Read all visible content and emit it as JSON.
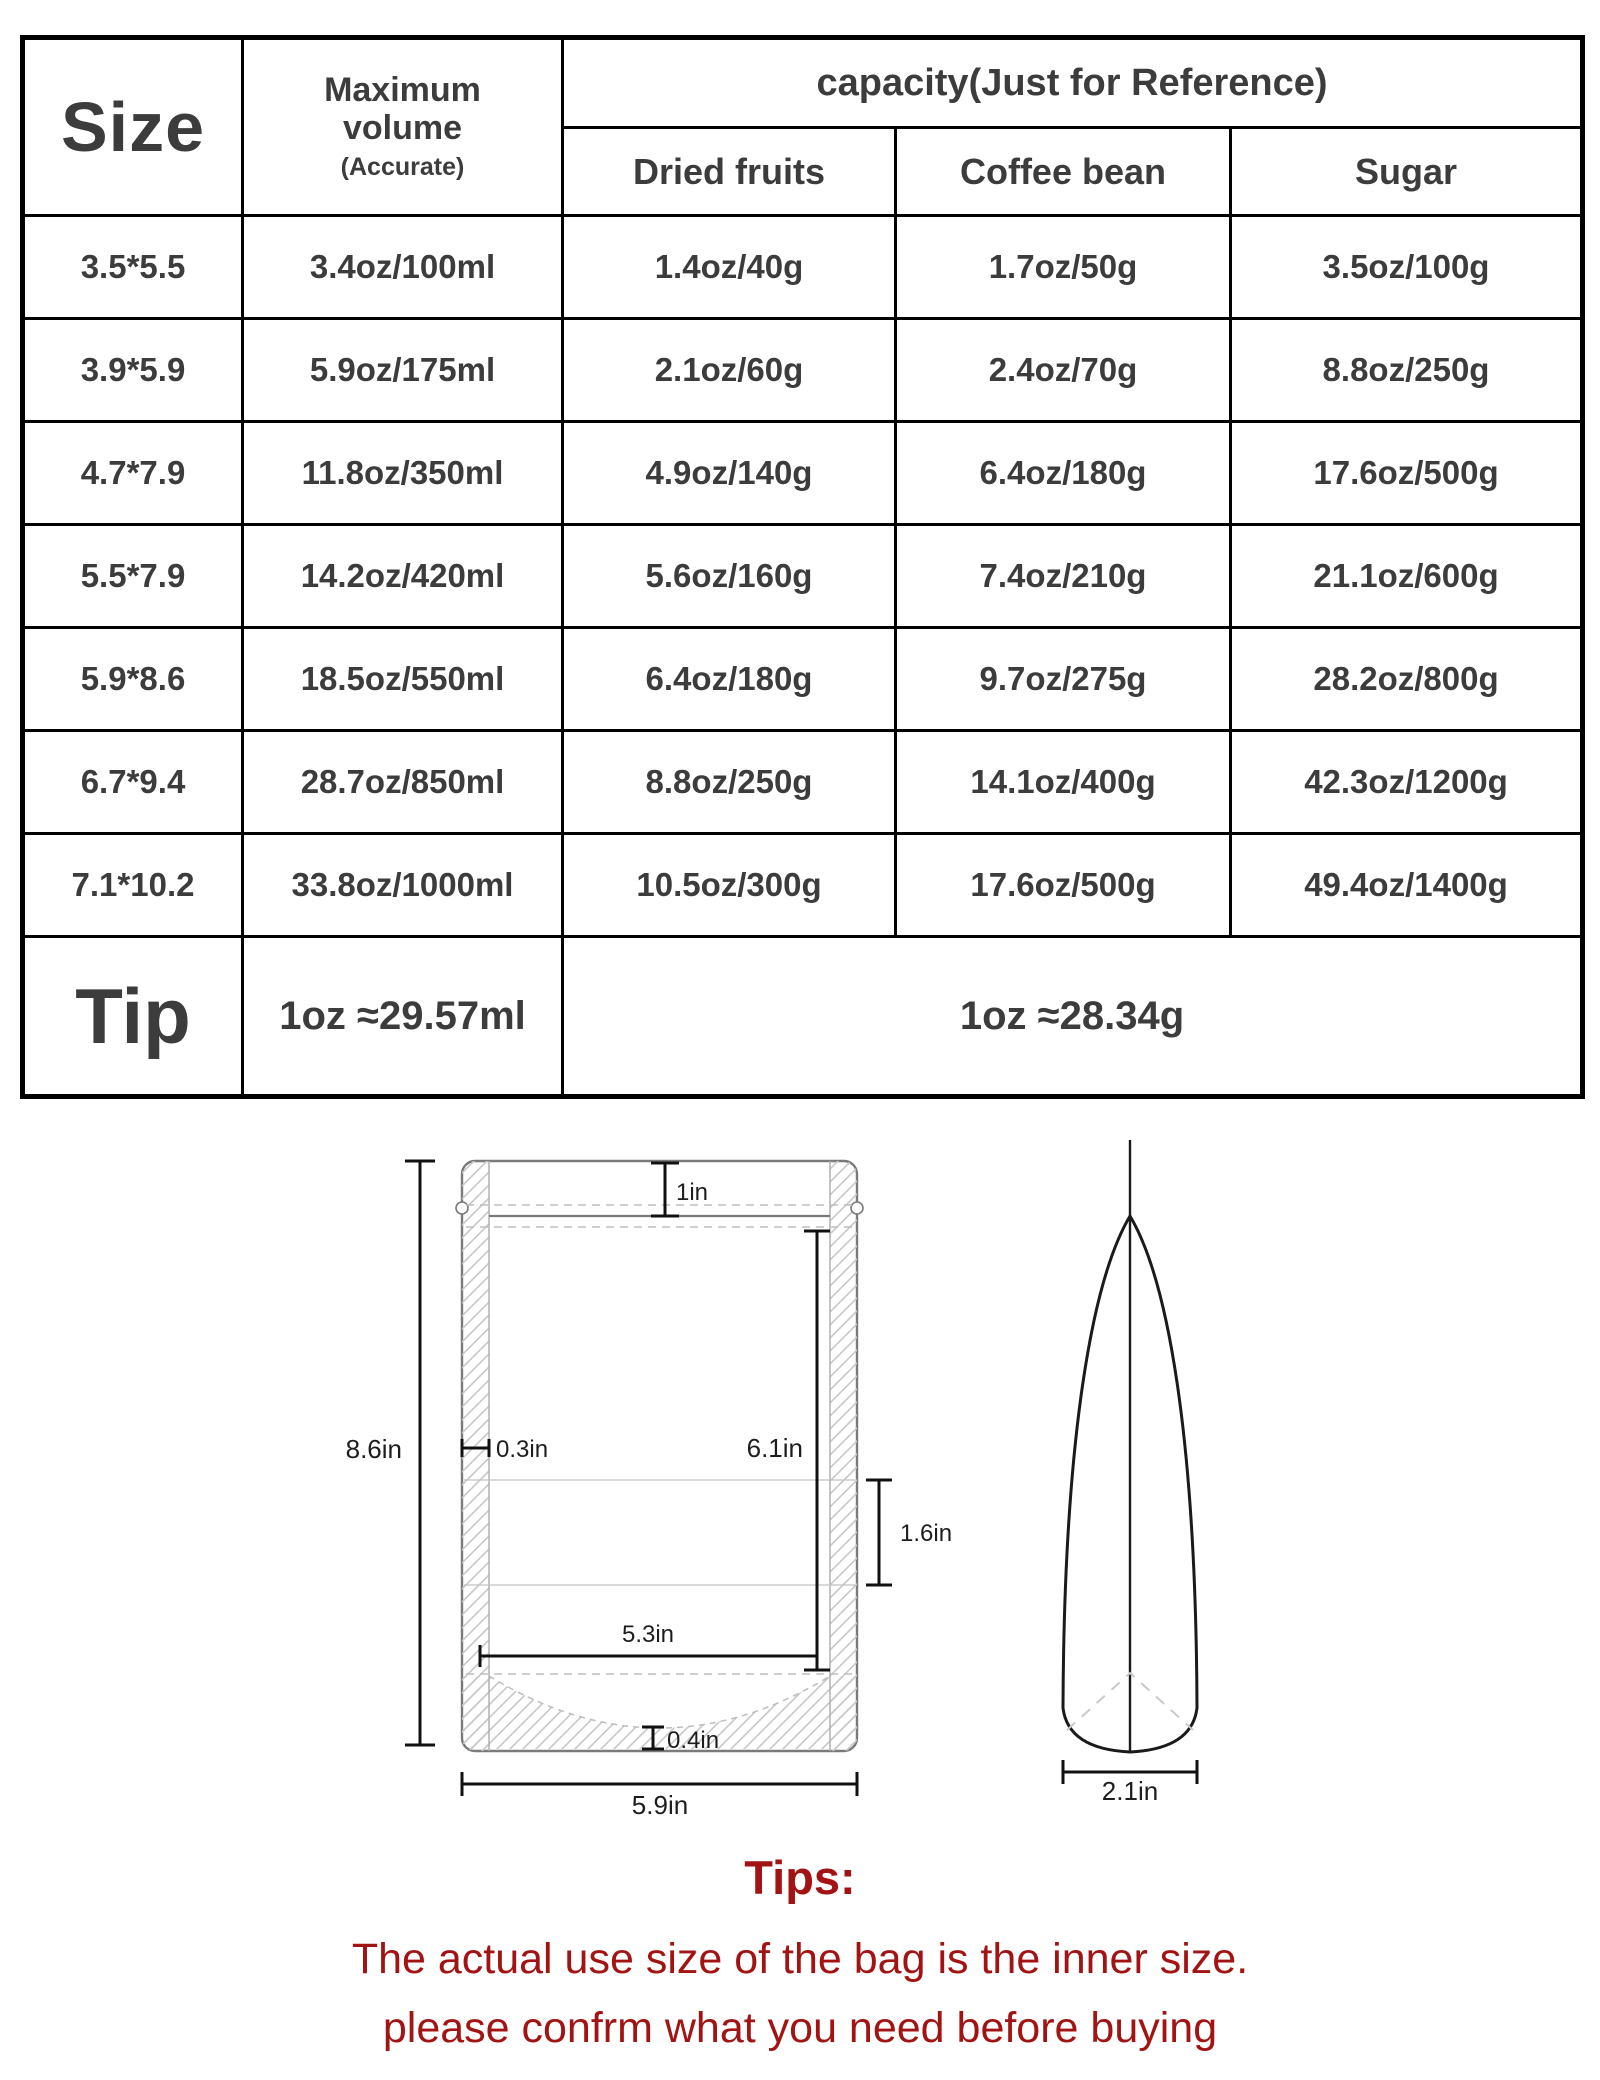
{
  "table": {
    "header": {
      "size": "Size",
      "max_volume": "Maximum volume",
      "max_volume_note": "(Accurate)",
      "capacity": "capacity(Just for Reference)",
      "sub": [
        "Dried fruits",
        "Coffee bean",
        "Sugar"
      ]
    },
    "rows": [
      [
        "3.5*5.5",
        "3.4oz/100ml",
        "1.4oz/40g",
        "1.7oz/50g",
        "3.5oz/100g"
      ],
      [
        "3.9*5.9",
        "5.9oz/175ml",
        "2.1oz/60g",
        "2.4oz/70g",
        "8.8oz/250g"
      ],
      [
        "4.7*7.9",
        "11.8oz/350ml",
        "4.9oz/140g",
        "6.4oz/180g",
        "17.6oz/500g"
      ],
      [
        "5.5*7.9",
        "14.2oz/420ml",
        "5.6oz/160g",
        "7.4oz/210g",
        "21.1oz/600g"
      ],
      [
        "5.9*8.6",
        "18.5oz/550ml",
        "6.4oz/180g",
        "9.7oz/275g",
        "28.2oz/800g"
      ],
      [
        "6.7*9.4",
        "28.7oz/850ml",
        "8.8oz/250g",
        "14.1oz/400g",
        "42.3oz/1200g"
      ],
      [
        "7.1*10.2",
        "33.8oz/1000ml",
        "10.5oz/300g",
        "17.6oz/500g",
        "49.4oz/1400g"
      ]
    ],
    "tip": {
      "label": "Tip",
      "volume": "1oz ≈29.57ml",
      "weight": "1oz ≈28.34g"
    }
  },
  "diagram": {
    "front": {
      "height": "8.6in",
      "top_zone": "1in",
      "seal_width": "0.3in",
      "inner_height": "6.1in",
      "band": "1.6in",
      "inner_width": "5.3in",
      "bottom_gusset": "0.4in",
      "outer_width": "5.9in"
    },
    "side": {
      "bottom_width": "2.1in"
    }
  },
  "tips": {
    "title": "Tips:",
    "line1": "The actual use size of the bag is the inner size.",
    "line2": "please confrm what you need before buying"
  },
  "colors": {
    "tips_red": "#a21414",
    "table_text": "#3c3c3c",
    "border_black": "#000000",
    "outline_gray": "#7a7a7a",
    "hatch_gray": "#c7c7c7"
  }
}
